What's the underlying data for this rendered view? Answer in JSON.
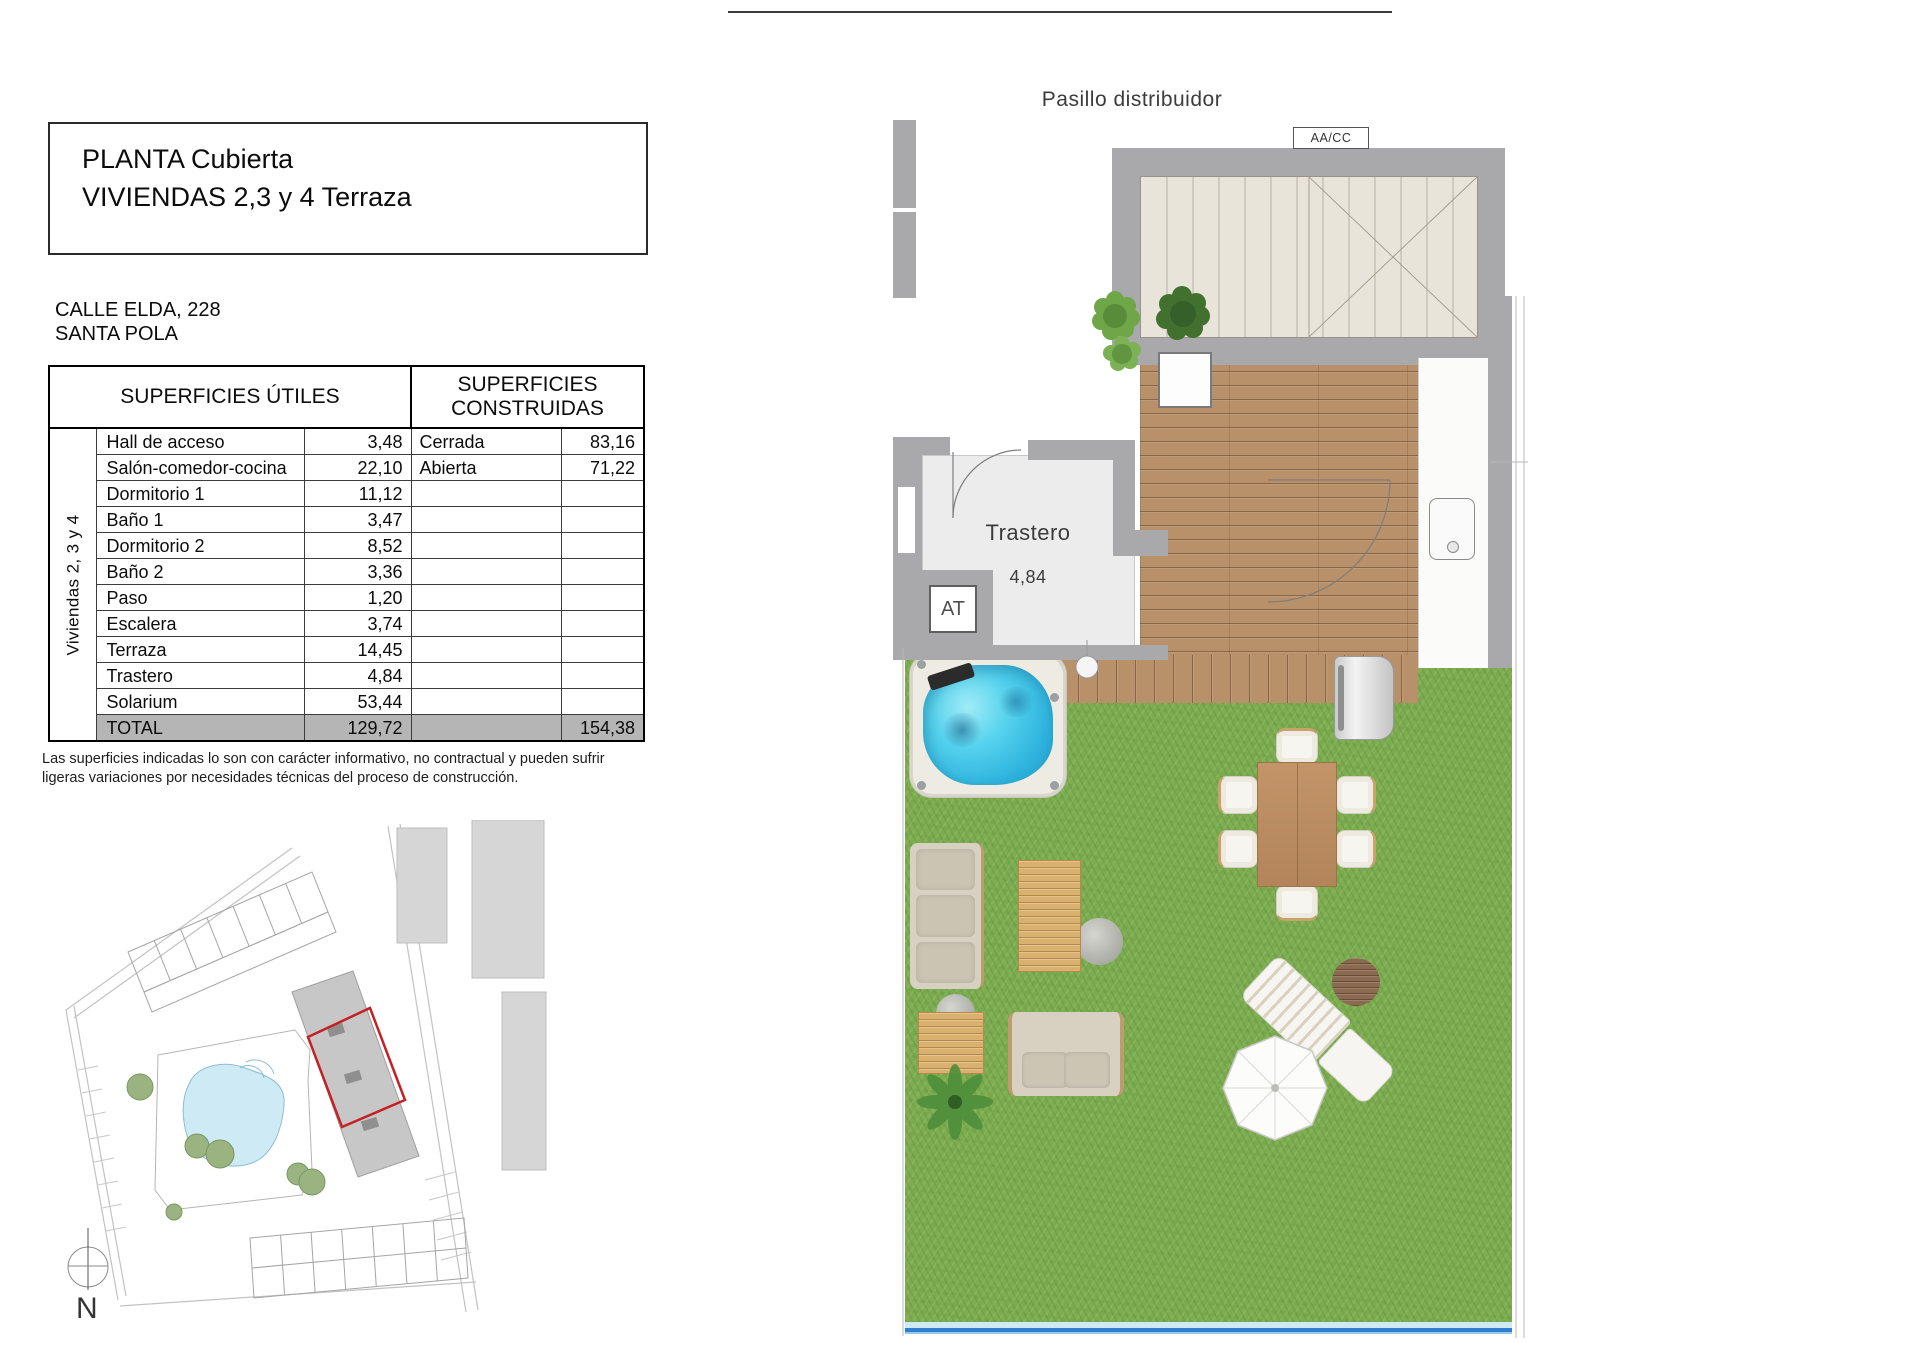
{
  "document": {
    "title_line1": "PLANTA Cubierta",
    "title_line2": "VIVIENDAS 2,3 y 4 Terraza",
    "address_line1": "CALLE ELDA, 228",
    "address_line2": "SANTA POLA",
    "footnote_line1": "Las superficies indicadas lo son con carácter informativo, no contractual y pueden sufrir",
    "footnote_line2": "ligeras variaciones por necesidades técnicas del proceso de construcción."
  },
  "surfaces_table": {
    "header_left": "SUPERFICIES ÚTILES",
    "header_right": "SUPERFICIES CONSTRUIDAS",
    "group_label": "Viviendas 2, 3 y 4",
    "rows": [
      {
        "name": "Hall de acceso",
        "value": "3,48",
        "c_name": "Cerrada",
        "c_value": "83,16"
      },
      {
        "name": "Salón-comedor-cocina",
        "value": "22,10",
        "c_name": "Abierta",
        "c_value": "71,22"
      },
      {
        "name": "Dormitorio 1",
        "value": "11,12",
        "c_name": "",
        "c_value": ""
      },
      {
        "name": "Baño 1",
        "value": "3,47",
        "c_name": "",
        "c_value": ""
      },
      {
        "name": "Dormitorio 2",
        "value": "8,52",
        "c_name": "",
        "c_value": ""
      },
      {
        "name": "Baño 2",
        "value": "3,36",
        "c_name": "",
        "c_value": ""
      },
      {
        "name": "Paso",
        "value": "1,20",
        "c_name": "",
        "c_value": ""
      },
      {
        "name": "Escalera",
        "value": "3,74",
        "c_name": "",
        "c_value": ""
      },
      {
        "name": "Terraza",
        "value": "14,45",
        "c_name": "",
        "c_value": ""
      },
      {
        "name": "Trastero",
        "value": "4,84",
        "c_name": "",
        "c_value": ""
      },
      {
        "name": "Solarium",
        "value": "53,44",
        "c_name": "",
        "c_value": ""
      }
    ],
    "total_row": {
      "label": "TOTAL",
      "useful_total": "129,72",
      "built_total": "154,38"
    }
  },
  "floor_plan": {
    "corridor_label": "Pasillo distribuidor",
    "ac_unit_label": "AA/CC",
    "storage_room_label": "Trastero",
    "storage_room_area": "4,84",
    "antenna_label": "AT"
  },
  "site_plan": {
    "north_label": "N",
    "highlight_color": "#c42127"
  },
  "colors": {
    "highlight_red": "#c42127",
    "grass_green": "#7dad51",
    "pool_water": "#cdeaf5",
    "spa_water": "#3fc6e6",
    "deck_wood": "#b8906a",
    "wall_grey": "#a9a9ab",
    "total_row_grey": "#b5b5b5"
  }
}
